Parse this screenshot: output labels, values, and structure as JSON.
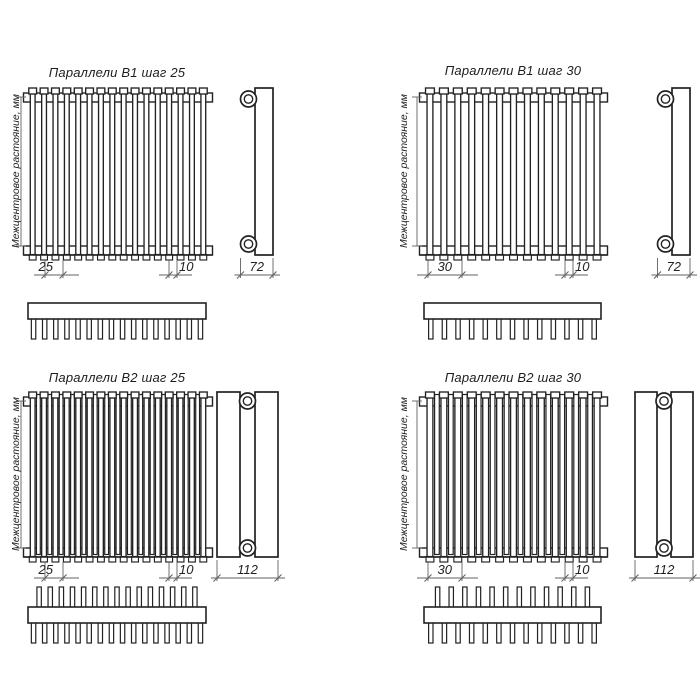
{
  "drawing": {
    "background": "#ffffff",
    "main_line_color": "#222222",
    "thin_line_color": "#616161",
    "text_color": "#1d1d1d"
  },
  "panels": [
    {
      "id": "b1-step25",
      "title": "Параллели В1 шаг 25",
      "axis_label": "Межцентровое растояние, мм",
      "rows": 1,
      "tube_count": 16,
      "step_label": "25",
      "tube_width_label": "10",
      "depth_label": "72"
    },
    {
      "id": "b1-step30",
      "title": "Параллели В1 шаг 30",
      "axis_label": "Межцентровое растояние, мм",
      "rows": 1,
      "tube_count": 13,
      "step_label": "30",
      "tube_width_label": "10",
      "depth_label": "72"
    },
    {
      "id": "b2-step25",
      "title": "Параллели В2 шаг 25",
      "axis_label": "Межцентровое растояние, мм",
      "rows": 2,
      "tube_count": 16,
      "step_label": "25",
      "tube_width_label": "10",
      "depth_label": "112"
    },
    {
      "id": "b2-step30",
      "title": "Параллели В2 шаг 30",
      "axis_label": "Межцентровое растояние, мм",
      "rows": 2,
      "tube_count": 13,
      "step_label": "30",
      "tube_width_label": "10",
      "depth_label": "112"
    }
  ]
}
